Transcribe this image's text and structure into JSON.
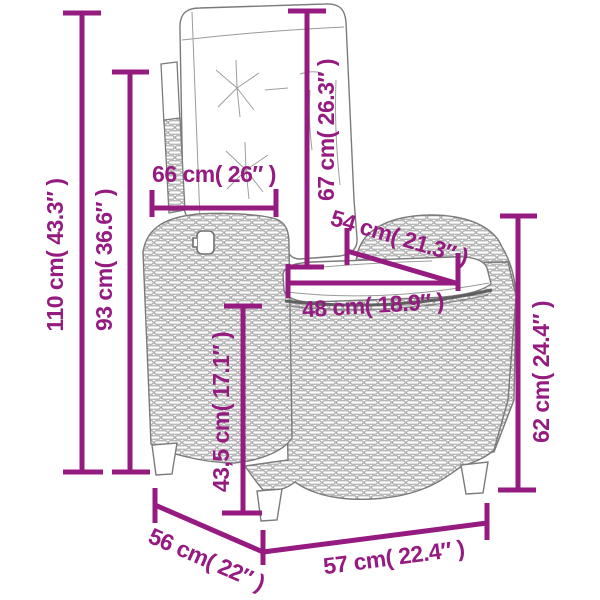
{
  "diagram": {
    "type": "product-dimension-diagram",
    "colors": {
      "dimension_annotation": "#951B81",
      "line_art": "#7B7B7B",
      "background": "#FFFFFF"
    },
    "dims": {
      "total_height": {
        "label": "110 cm( 43.3″ )"
      },
      "backrest_height": {
        "label": "93 cm( 36.6″ )"
      },
      "backrest_width": {
        "label": "66 cm( 26″ )"
      },
      "back_cushion_length": {
        "label": "67 cm( 26.3″ )"
      },
      "armrest_length": {
        "label": "54 cm( 21.3″ )"
      },
      "seat_width": {
        "label": "48 cm( 18.9″ )"
      },
      "seat_height": {
        "label": "43,5 cm( 17.1″ )"
      },
      "armrest_height": {
        "label": "62 cm( 24.4″ )"
      },
      "base_depth": {
        "label": "56 cm( 22″ )"
      },
      "base_width": {
        "label": "57 cm( 22.4″ )"
      }
    }
  }
}
